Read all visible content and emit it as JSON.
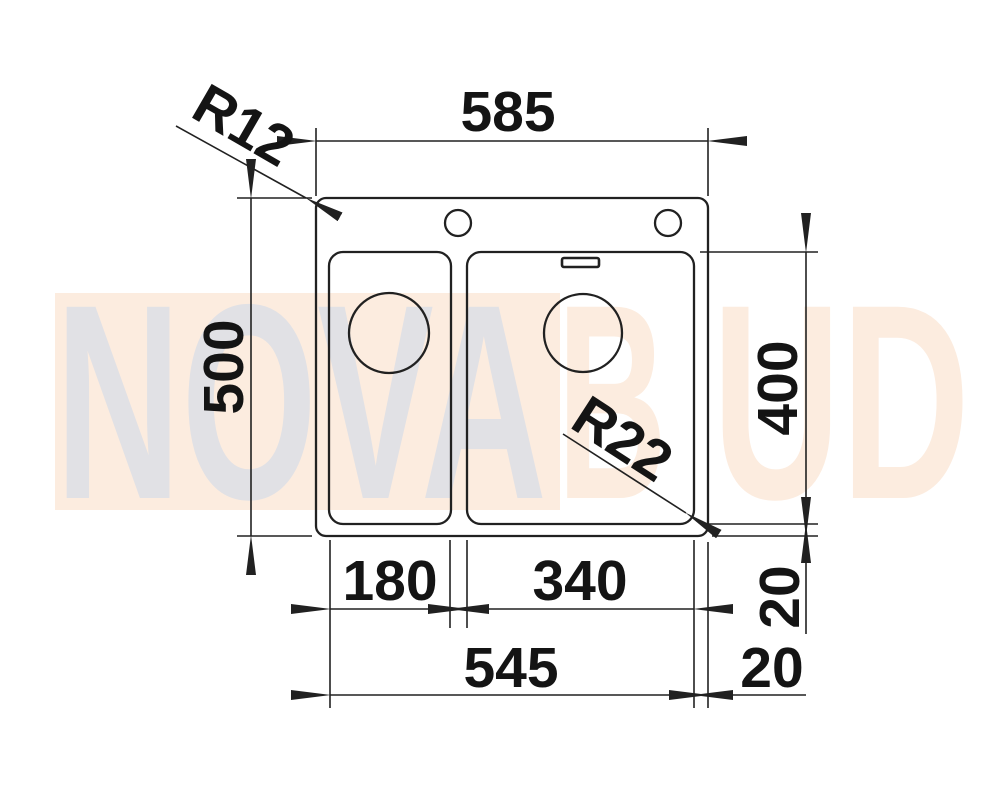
{
  "page": {
    "background_color": "#ffffff",
    "line_color": "#212121",
    "dimension_text_color": "#141414"
  },
  "drawing": {
    "type": "technical-dimension-drawing",
    "subject": "one-and-a-half bowl inset kitchen sink, top view",
    "labels": {
      "overall_width": "585",
      "outer_corner_radius": "R12",
      "overall_depth": "500",
      "bowl_depth": "400",
      "bowl_corner_radius": "R22",
      "left_bowl_width": "180",
      "right_bowl_width": "340",
      "bowls_overall_width": "545",
      "bottom_edge_offset": "20",
      "right_edge_offset": "20"
    },
    "watermark": {
      "full_text": "NOVABUD",
      "segment_gray": "NOVA",
      "segment_peach_b": "B",
      "segment_peach_ud": "UD",
      "gray_color": "#e1e1e5",
      "peach_color": "#fcecdf",
      "band_color": "#fcecdf"
    }
  }
}
